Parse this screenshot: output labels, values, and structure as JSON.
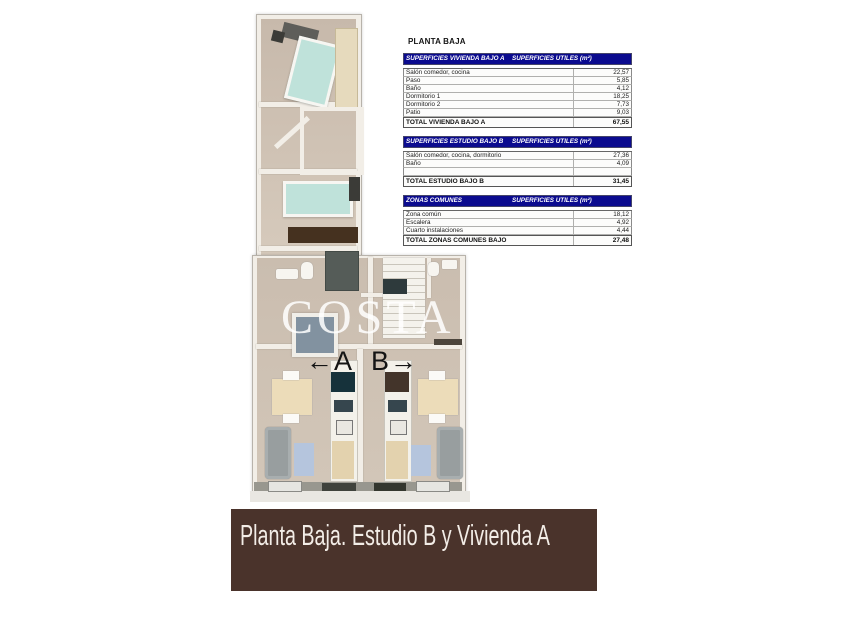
{
  "title": "PLANTA BAJA",
  "tables": [
    {
      "header_left": "SUPERFICIES VIVIENDA BAJO A",
      "header_right": "SUPERFICIES UTILES  (m²)",
      "rows": [
        {
          "label": "Salón comedor, cocina",
          "value": "22,57"
        },
        {
          "label": "Paso",
          "value": "5,85"
        },
        {
          "label": "Baño",
          "value": "4,12"
        },
        {
          "label": "Dormitorio 1",
          "value": "18,25"
        },
        {
          "label": "Dormitorio 2",
          "value": "7,73"
        },
        {
          "label": "Patio",
          "value": "9,03"
        }
      ],
      "total_label": "TOTAL VIVIENDA BAJO A",
      "total_value": "67,55"
    },
    {
      "header_left": "SUPERFICIES ESTUDIO BAJO B",
      "header_right": "SUPERFICIES UTILES  (m²)",
      "rows": [
        {
          "label": "Salón comedor, cocina, dormitorio",
          "value": "27,36"
        },
        {
          "label": "Baño",
          "value": "4,09"
        },
        {
          "label": "",
          "value": ""
        }
      ],
      "total_label": "TOTAL ESTUDIO BAJO B",
      "total_value": "31,45"
    },
    {
      "header_left": "ZONAS COMUNES",
      "header_right": "SUPERFICIES UTILES  (m²)",
      "rows": [
        {
          "label": "Zona común",
          "value": "18,12"
        },
        {
          "label": "Escalera",
          "value": "4,92"
        },
        {
          "label": "Cuarto instalaciones",
          "value": "4,44"
        }
      ],
      "total_label": "TOTAL ZONAS COMUNES BAJO",
      "total_value": "27,48"
    }
  ],
  "plan": {
    "watermark": "COSTA",
    "arrow_left": "←",
    "label_a": "A",
    "label_b": "B",
    "arrow_right": "→"
  },
  "banner": {
    "text": "Planta Baja. Estudio B y Vivienda A"
  },
  "colors": {
    "table_header_bg": "#0b0b8f",
    "banner_bg": "#4a332b",
    "banner_text": "#f3ede7",
    "watermark_color": "rgba(255,255,255,0.85)"
  }
}
